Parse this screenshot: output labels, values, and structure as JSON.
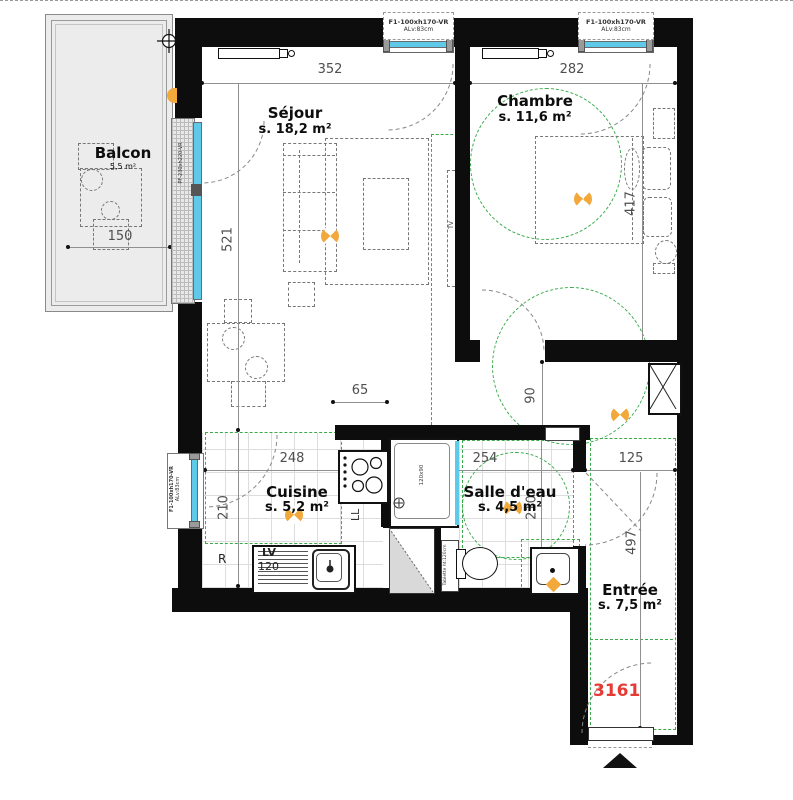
{
  "rooms": {
    "balcon": {
      "name": "Balcon",
      "area": "5,5 m²"
    },
    "sejour": {
      "name": "Séjour",
      "area": "s. 18,2 m²"
    },
    "chambre": {
      "name": "Chambre",
      "area": "s. 11,6 m²"
    },
    "cuisine": {
      "name": "Cuisine",
      "area": "s. 5,2 m²"
    },
    "salle_deau": {
      "name": "Salle d'eau",
      "area": "s. 4,5 m²"
    },
    "entree": {
      "name": "Entrée",
      "area": "s. 7,5 m²"
    }
  },
  "dims": {
    "sejour_w": "352",
    "chambre_w": "282",
    "balcon_w": "150",
    "sejour_h": "521",
    "chambre_h": "417",
    "hall_w": "65",
    "hall_h": "90",
    "cuisine_w": "248",
    "salle_deau_w": "254",
    "entree_w": "125",
    "cuisine_h": "210",
    "salle_deau_h": "210",
    "entree_h": "497"
  },
  "unit": {
    "number": "3161"
  },
  "windows": {
    "label_line1": "F1-100xh170-VR",
    "label_line2": "ALv:83cm",
    "balcony_door": "PF-230xh220-VR"
  },
  "fixtures": {
    "dishwasher": "LV",
    "dishwasher_width": "120",
    "fridge": "R",
    "washer": "LL",
    "tv": "TV",
    "shower_size": "120x90",
    "shelf": "Tablette ht:120cm"
  },
  "colors": {
    "wall": "#0d0d0d",
    "glazing": "#5fc9e9",
    "accessibility_green": "#3aaa4a",
    "light_orange": "#f2a83b",
    "unit_red": "#e63a35",
    "balcony_gray": "#ececec"
  }
}
